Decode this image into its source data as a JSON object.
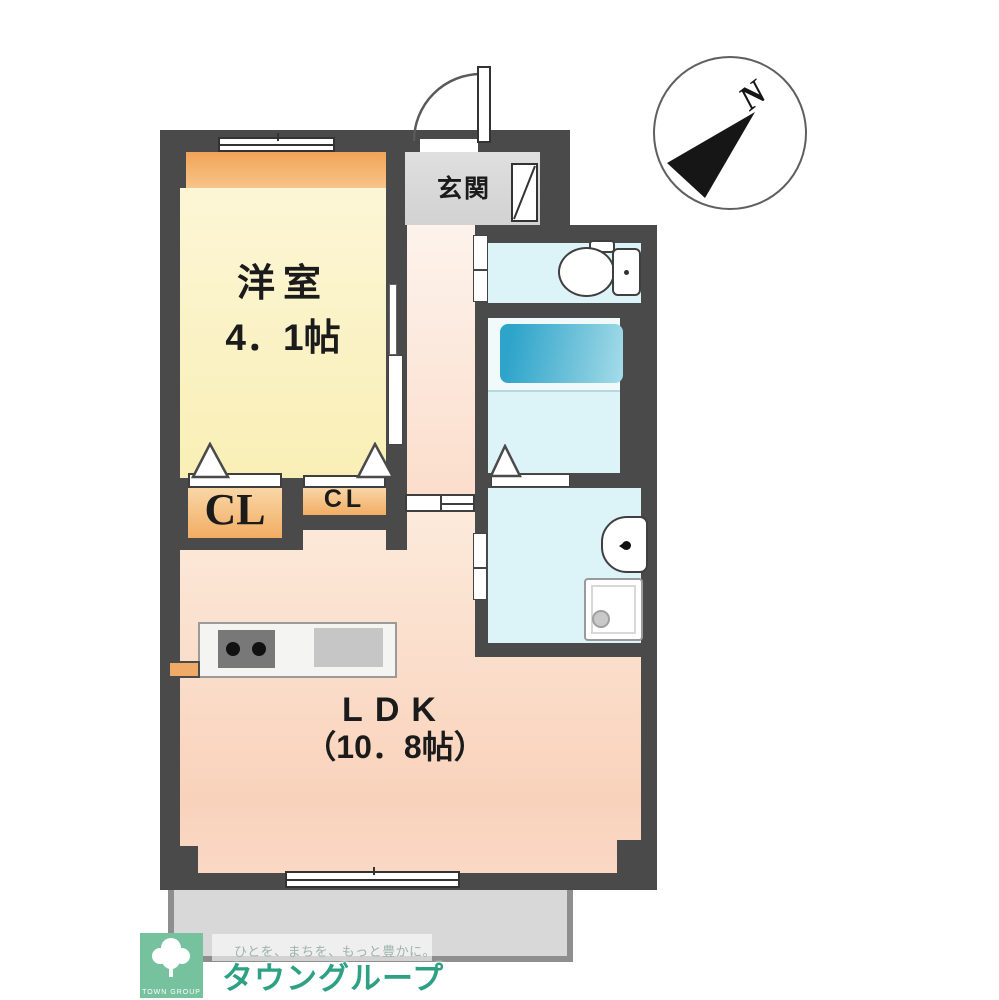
{
  "floorplan": {
    "compass": {
      "north_label": "N"
    },
    "rooms": {
      "western_room": {
        "name": "洋室",
        "size": "4．1帖"
      },
      "entrance": {
        "name": "玄関"
      },
      "ldk": {
        "name": "LDK",
        "size": "（10．8帖）"
      },
      "closet_large": {
        "name": "CL"
      },
      "closet_small": {
        "name": "CL"
      }
    },
    "fixtures": [
      "toilet",
      "bathtub",
      "washbasin",
      "washing-machine-pan",
      "kitchen-stove",
      "kitchen-sink",
      "shoe-cabinet"
    ],
    "colors": {
      "wall": "#4a4a4a",
      "western_room_floor": "#fbf2c4",
      "ldk_floor": "#f9d2bb",
      "wet_area_floor": "#dcf3f8",
      "bathtub": "#2ea4ca",
      "closet_floor": "#f2ad63",
      "entrance_floor": "#d5d5d5",
      "balcony": "#d8d8d8",
      "accent_shelf": "#f0a457",
      "brand_green": "#2ea184"
    }
  },
  "footer": {
    "logo_box_text": "TOWN GROUP",
    "slogan": "ひとを、まちを、もっと豊かに。",
    "brand": "タウングループ"
  }
}
